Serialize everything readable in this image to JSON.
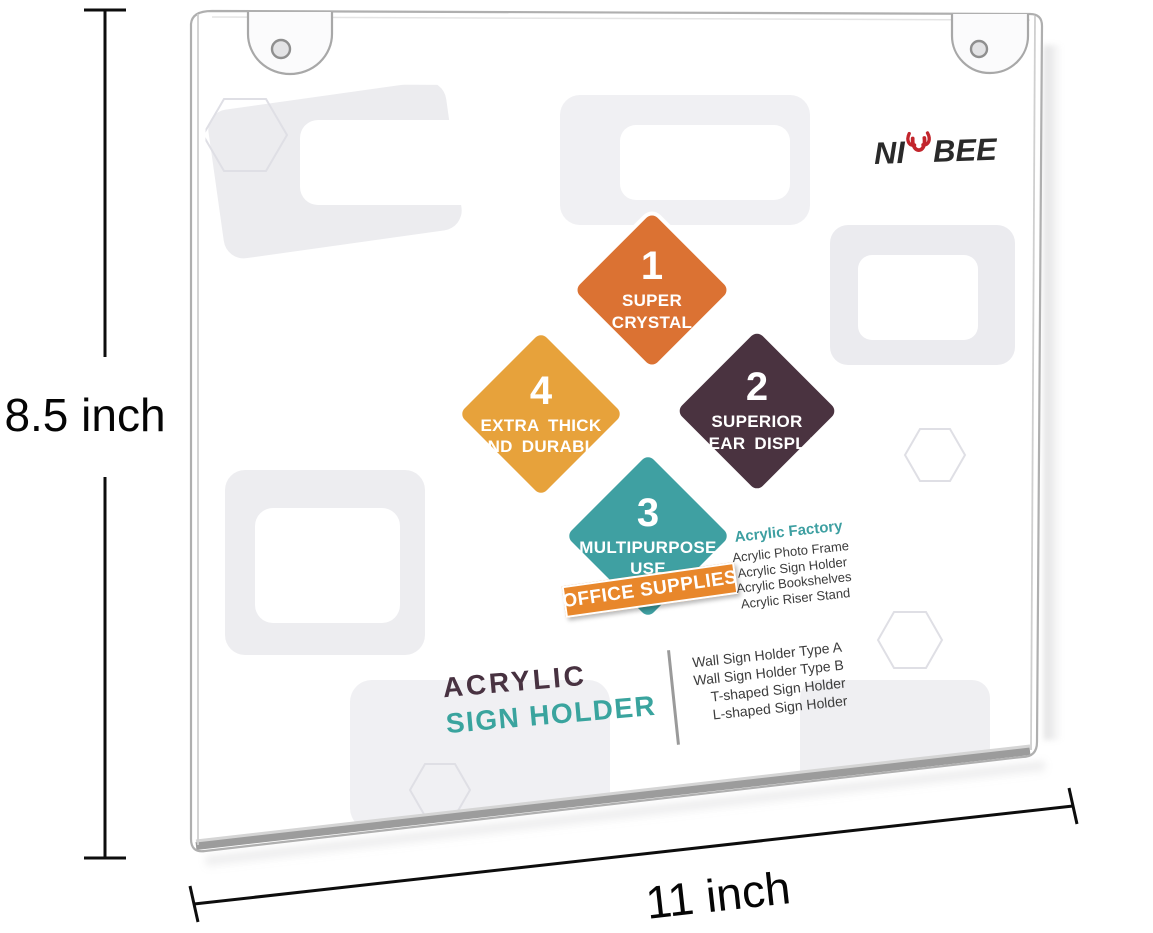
{
  "dimensions": {
    "height_label": "8.5 inch",
    "width_label": "11 inch"
  },
  "brand": {
    "prefix": "NI",
    "suffix": "BEE",
    "full_name": "NIUBEE"
  },
  "features": [
    {
      "num": "1",
      "line1": "SUPER",
      "line2": "CRYSTAL",
      "color": "#DB7233"
    },
    {
      "num": "2",
      "line1": "SUPERIOR",
      "line2": "CLEAR DISPLAY",
      "color": "#4A3340"
    },
    {
      "num": "3",
      "line1": "MULTIPURPOSE",
      "line2": "USE",
      "color": "#3FA0A2"
    },
    {
      "num": "4",
      "line1": "EXTRA THICK",
      "line2": "AND DURABLE",
      "color": "#E7A23B"
    }
  ],
  "badge": {
    "label": "OFFICE SUPPLIES",
    "color": "#E8872B"
  },
  "factory": {
    "title": "Acrylic Factory",
    "items": [
      "Acrylic Photo Frame",
      "Acrylic Sign Holder",
      "Acrylic Bookshelves",
      "Acrylic Riser Stand"
    ]
  },
  "product_title": {
    "line1": "ACRYLIC",
    "line2": "SIGN HOLDER"
  },
  "holder_types": [
    "Wall Sign Holder Type A",
    "Wall Sign Holder Type B",
    "T-shaped Sign Holder",
    "L-shaped Sign Holder"
  ],
  "colors": {
    "brand_red": "#C2252C",
    "title_purple": "#483241",
    "title_teal": "#3AA49E",
    "factory_teal": "#3D9FA1",
    "badge_orange": "#E8872B"
  }
}
